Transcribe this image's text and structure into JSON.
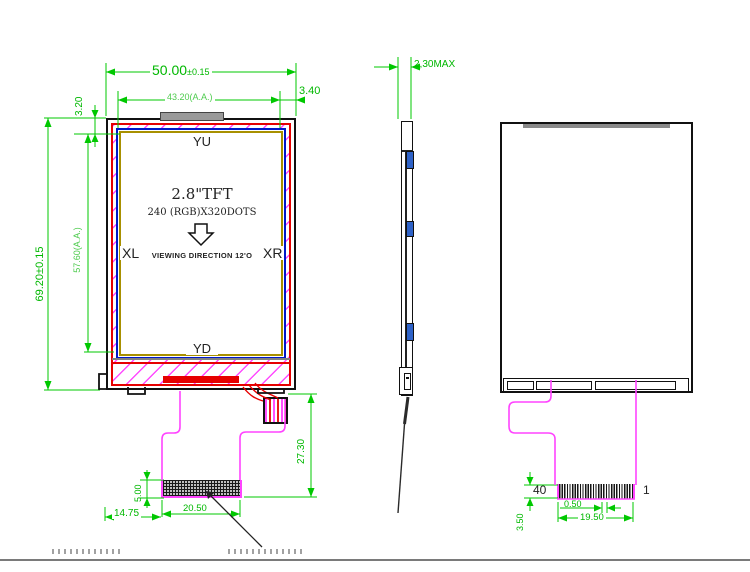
{
  "front": {
    "dim_width": "50.00",
    "dim_width_tol": "±0.15",
    "dim_aa_width": "43.20(A.A.)",
    "dim_margin_right": "3.40",
    "dim_margin_top": "3.20",
    "dim_height": "69.20±0.15",
    "dim_aa_height": "57.60(A.A.)",
    "label_yu": "YU",
    "label_yd": "YD",
    "label_xl": "XL",
    "label_xr": "XR",
    "screen_line1": "2.8\"TFT",
    "screen_line2": "240 (RGB)X320DOTS",
    "screen_line3": "VIEWING DIRECTION 12'O",
    "dim_flex_length": "27.30",
    "dim_pad_height": "5.00",
    "dim_pad_width": "20.50",
    "dim_pad_offset": "14.75"
  },
  "side": {
    "dim_thickness": "2,30MAX"
  },
  "back": {
    "pin_last": "40",
    "pin_first": "1",
    "dim_pin_pitch": "0.50",
    "dim_pad_width": "19.50",
    "dim_pad_height": "3.50"
  },
  "colors": {
    "dimension_green": "#00b800",
    "flex_magenta": "#ff44ff",
    "bezel_red": "#e60000",
    "tape_blue": "#2e62c8",
    "aa_border_yellow": "#a89000"
  }
}
